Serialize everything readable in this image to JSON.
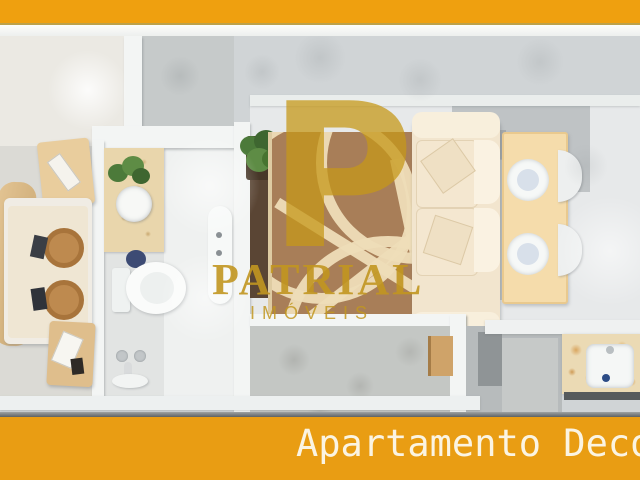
{
  "header": {
    "bar_color": "#EFA00F"
  },
  "watermark": {
    "monogram": "P",
    "brand": "PATRIAL",
    "subtitle": "IMÓVEIS",
    "color": "#C49A22"
  },
  "caption": {
    "text": "Apartamento Deco",
    "bar_color": "#E99D13",
    "text_color": "#FBF4E2"
  },
  "scene": {
    "type": "apartment-floor-plan-render",
    "rooms": [
      "bedroom",
      "bathroom",
      "living-room",
      "dining-area",
      "balcony",
      "kitchen"
    ],
    "palette": {
      "wall": "#F3F5F4",
      "rug_brown": "#A87E58",
      "rug_pattern": "#EEDDB8",
      "wood_light": "#E9CD9D",
      "sofa_cream": "#F2E5CE",
      "counter_granite": "#EBDAB4"
    }
  }
}
